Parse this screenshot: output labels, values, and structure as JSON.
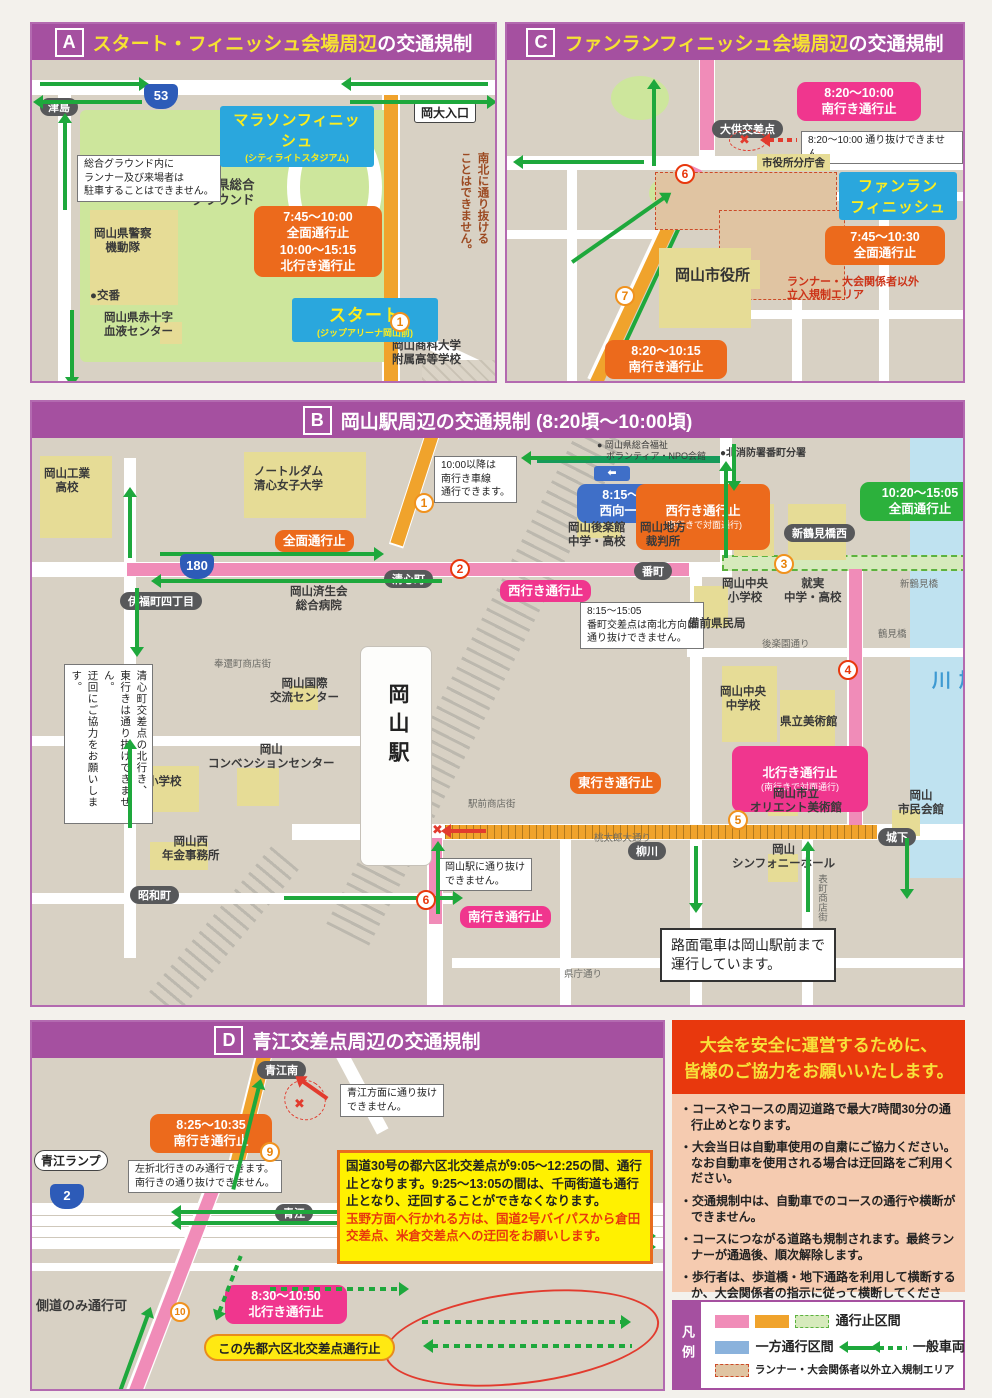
{
  "colors": {
    "purple": "#a550a0",
    "pink_route": "#f08cb8",
    "orange_route": "#f0a32c",
    "green_arrow": "#1ea83c",
    "pink_callout": "#f0368e",
    "orange_callout": "#ec6a1c",
    "green_callout": "#2cb13c",
    "blue_callout": "#3f6fc8",
    "red": "#e8380d",
    "yellow": "#f6e232"
  },
  "a": {
    "letter": "A",
    "title_hl": "スタート・フィニッシュ会場周辺",
    "title_rest": "の交通規制",
    "tsushima": "津島",
    "r53": "53",
    "finish": "マラソンフィニッシュ",
    "finish_sub": "(シティライトスタジアム)",
    "okadai": "岡大入口",
    "ground": "岡山県総合\nグラウンド",
    "note_parking": "総合グラウンド内に\nランナー及び来場者は\n駐車することはできません。",
    "police": "岡山県警察\n機動隊",
    "koban": "●交番",
    "redcross": "岡山県赤十字\n血液センター",
    "times": "7:45〜10:00\n全面通行止\n10:00〜15:15\n北行き通行止",
    "start": "スタート",
    "start_sub": "(ジップアリーナ岡山前)",
    "m1": "1",
    "school": "岡山商科大学\n附属高等学校",
    "side": "歩行者・自転車も\n南北に通り抜ける\nことはできません。"
  },
  "c": {
    "letter": "C",
    "title_hl": "ファンランフィニッシュ会場周辺",
    "title_rest": "の交通規制",
    "co_south": "8:20〜10:00\n南行き通行止",
    "daiku": "大供交差点",
    "no_pass": "8:20〜10:00 通り抜けできません。",
    "bunchosha": "市役所分庁舎",
    "funrun": "ファンラン\nフィニッシュ",
    "co_full": "7:45〜10:30\n全面通行止",
    "cityhall": "岡山市役所",
    "area_note": "ランナー・大会関係者以外\n立入規制エリア",
    "m6": "6",
    "m7": "7",
    "co_south2": "8:20〜10:15\n南行き通行止"
  },
  "b": {
    "letter": "B",
    "title": "岡山駅周辺の交通規制 (8:20頃〜10:00頃)",
    "kogyo": "岡山工業\n高校",
    "notredame": "ノートルダム\n清心女子大学",
    "note1000": "10:00以降は\n南行き車線\n通行できます。",
    "npo": "● 岡山県総合福祉\n　ボランティア・NPO会館",
    "fire": "●北消防署番町分署",
    "co_oneway": "8:15〜15:05\n西向一方通行",
    "co_west2": "西行き通行止",
    "co_west2_sub": "(東行きで対面通行)",
    "co_green": "10:20〜15:05\n全面通行止",
    "m1": "1",
    "m2": "2",
    "m3": "3",
    "m4": "4",
    "m5": "5",
    "m6": "6",
    "co_full": "全面通行止",
    "korakukan": "岡山後楽館\n中学・高校",
    "court": "岡山地方\n裁判所",
    "shintsurumiw": "新鶴見橋西",
    "shintsurumi": "新鶴見橋",
    "r180": "180",
    "ifuku": "伊福町四丁目",
    "saiseikai": "岡山済生会\n総合病院",
    "seishin": "清心町",
    "co_west": "西行き通行止",
    "bancho": "番町",
    "note_bancho": "8:15〜15:05\n番町交差点は南北方向に\n通り抜けできません。",
    "chuo_es": "岡山中央\n小学校",
    "shujitsu": "就実\n中学・高校",
    "bizen": "備前県民局",
    "korakuen_st": "後楽園通り",
    "chuo_jhs": "岡山中央\n中学校",
    "pref_museum": "県立美術館",
    "co_north": "北行き通行止",
    "co_north_sub": "(南行きで対面通行)",
    "orient": "岡山市立\nオリエント美術館",
    "shiminkaikan": "岡山\n市民会館",
    "tsurumibashi": "鶴見橋",
    "asahikawa": "旭\n川",
    "shiro": "城下",
    "symphony": "岡山\nシンフォニーホール",
    "omotecho": "表町商店街",
    "yanagawa": "柳川",
    "co_east": "東行き通行止",
    "momotaro": "桃太郎大通り",
    "ekimae": "駅前商店街",
    "note_station": "岡山駅に通り抜け\nできません。",
    "co_south": "南行き通行止",
    "station": "岡山駅",
    "ishii": "石井小学校",
    "intl": "岡山国際\n交流センター",
    "convention": "岡山\nコンベンションセンター",
    "nenkin": "岡山西\n年金事務所",
    "showacho": "昭和町",
    "hokancho": "奉還町商店街",
    "note_seishin": "清心町交差点の北行き、\n東行きは通り抜けできません。\n迂回にご協力をお願いします。",
    "note_tram": "路面電車は岡山駅前まで\n運行しています。",
    "kencho": "県庁通り"
  },
  "d": {
    "letter": "D",
    "title": "青江交差点周辺の交通規制",
    "aoeminami": "青江南",
    "note_aoe": "青江方面に通り抜け\nできません。",
    "co_south": "8:25〜10:35\n南行き通行止",
    "m9": "9",
    "ramp": "青江ランプ",
    "note_left": "左折北行きのみ通行できます。\n南行きの通り抜けできません。",
    "r2": "2",
    "aoe": "青江",
    "sokudo": "側道のみ通行可",
    "m10": "10",
    "co_north": "8:30〜10:50\n北行き通行止",
    "oval": "この先都六区北交差点通行止",
    "box_black": "国道30号の都六区北交差点が9:05〜12:25の間、通行止となります。9:25〜13:05の間は、千両街道も通行止となり、迂回することができなくなります。",
    "box_red": "玉野方面へ行かれる方は、国道2号バイパスから倉田交差点、米倉交差点への迂回をお願いします。"
  },
  "info": {
    "title1": "大会を安全に運営するために、",
    "title2": "皆様のご協力をお願いいたします。",
    "bullets": [
      "・コースやコースの周辺道路で最大7時間30分の通行止めとなります。",
      "・大会当日は自動車使用の自粛にご協力ください。なお自動車を使用される場合は迂回路をご利用ください。",
      "・交通規制中は、自動車でのコースの通行や横断ができません。",
      "・コースにつながる道路も規制されます。最終ランナーが通過後、順次解除します。",
      "・歩行者は、歩道橋・地下通路を利用して横断するか、大会関係者の指示に従って横断してください。"
    ]
  },
  "legend": {
    "tab": "凡例",
    "closed": "通行止区間",
    "oneway": "一方通行区間",
    "general": "一般車両",
    "area": "ランナー・大会関係者以外立入規制エリア"
  }
}
